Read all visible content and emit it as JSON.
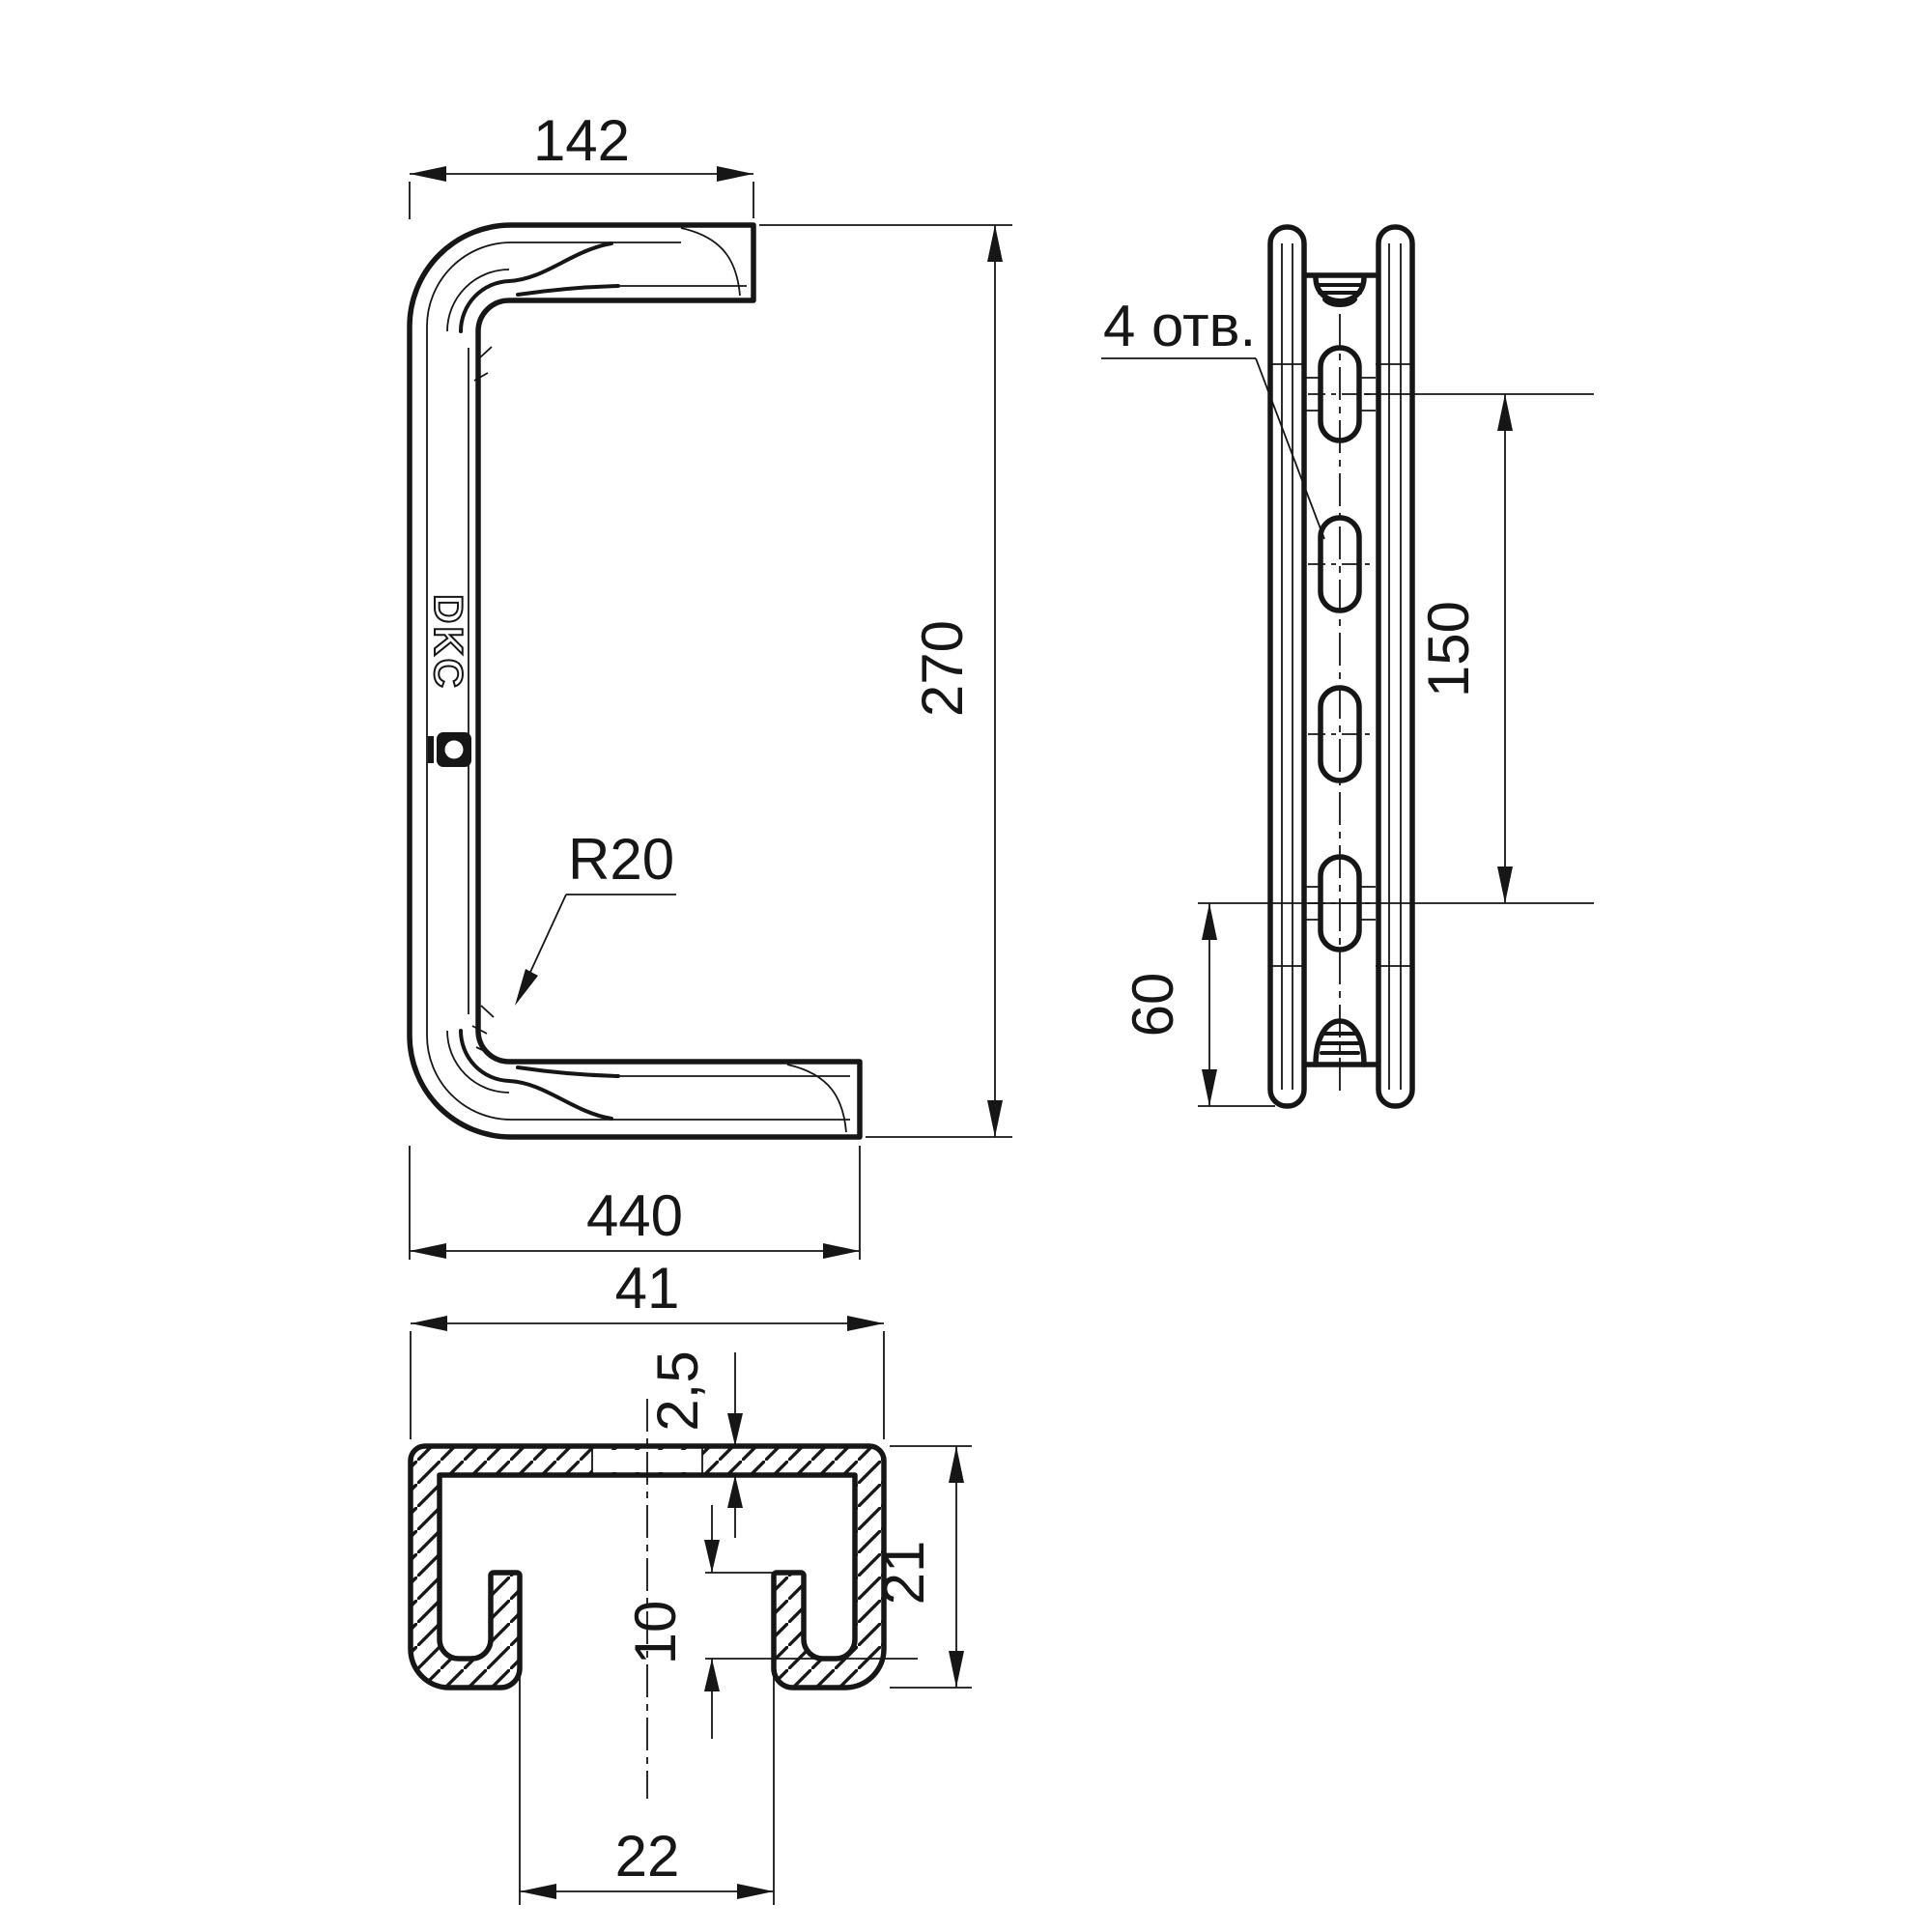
{
  "ink_color": "#161616",
  "brand": {
    "logo_text": "DKC"
  },
  "views": {
    "front": {
      "dim_top_width": "142",
      "dim_height": "270",
      "dim_bottom_width": "440",
      "bend_radius": "R20"
    },
    "side": {
      "holes_note": "4 отв.",
      "dim_hole_spacing": "150",
      "dim_bottom_hole_offset": "60"
    },
    "section": {
      "dim_width": "41",
      "dim_wall_thickness": "2,5",
      "dim_lip_height": "10",
      "dim_height": "21",
      "dim_opening_width": "22"
    }
  }
}
